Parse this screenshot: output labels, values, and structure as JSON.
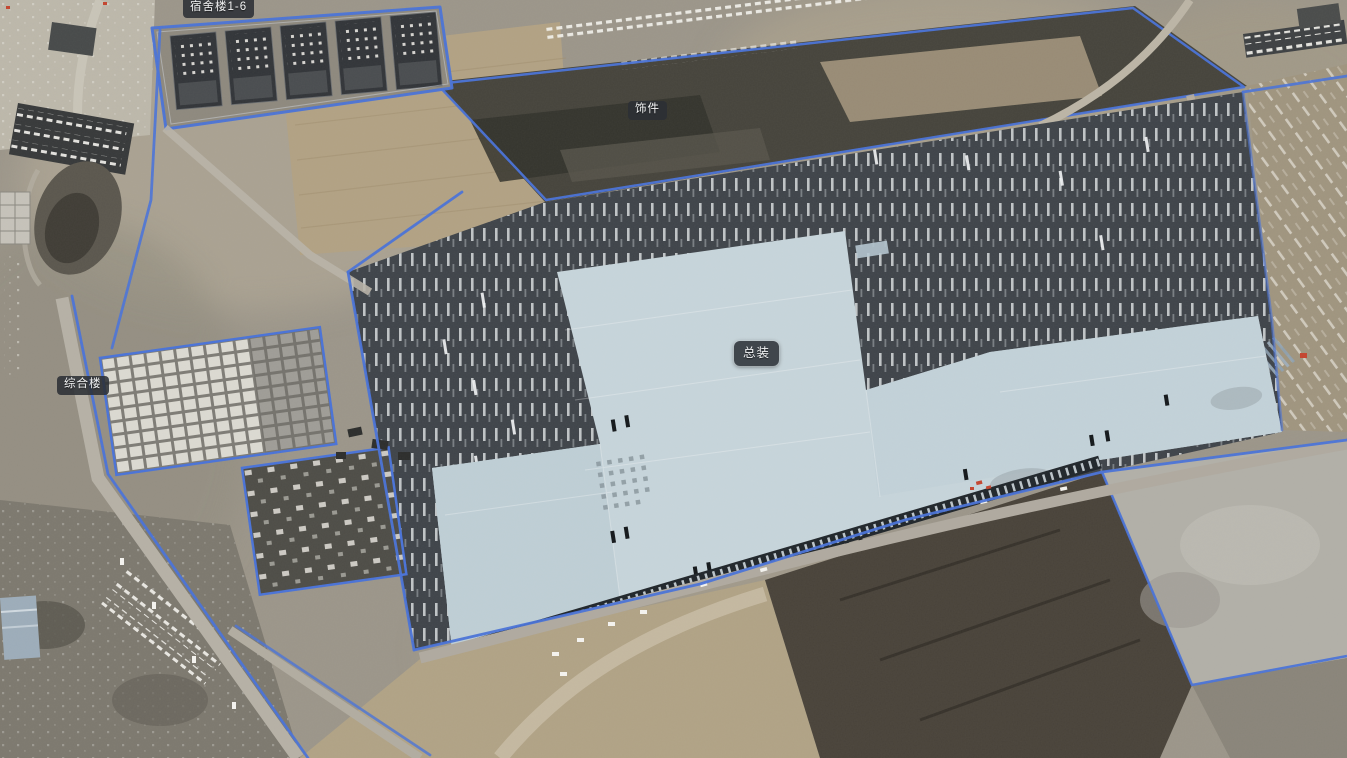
{
  "map": {
    "view_description": "aerial satellite view of a large factory construction site with annotated zones",
    "labels": [
      {
        "id": "dormitories",
        "text": "宿舍楼1-6",
        "x": 218,
        "y": 8
      },
      {
        "id": "trim-shop",
        "text": "饰件",
        "x": 651,
        "y": 114
      },
      {
        "id": "final-assembly",
        "text": "总装",
        "x": 757,
        "y": 355
      },
      {
        "id": "complex-building",
        "text": "综合楼",
        "x": 90,
        "y": 388
      }
    ],
    "annotation": {
      "boundary_line_color": "#4a73d8",
      "label_background": "rgba(44,48,53,0.9)",
      "label_text_color": "#f3f4f5",
      "roof_color": "#c7d5db"
    }
  }
}
